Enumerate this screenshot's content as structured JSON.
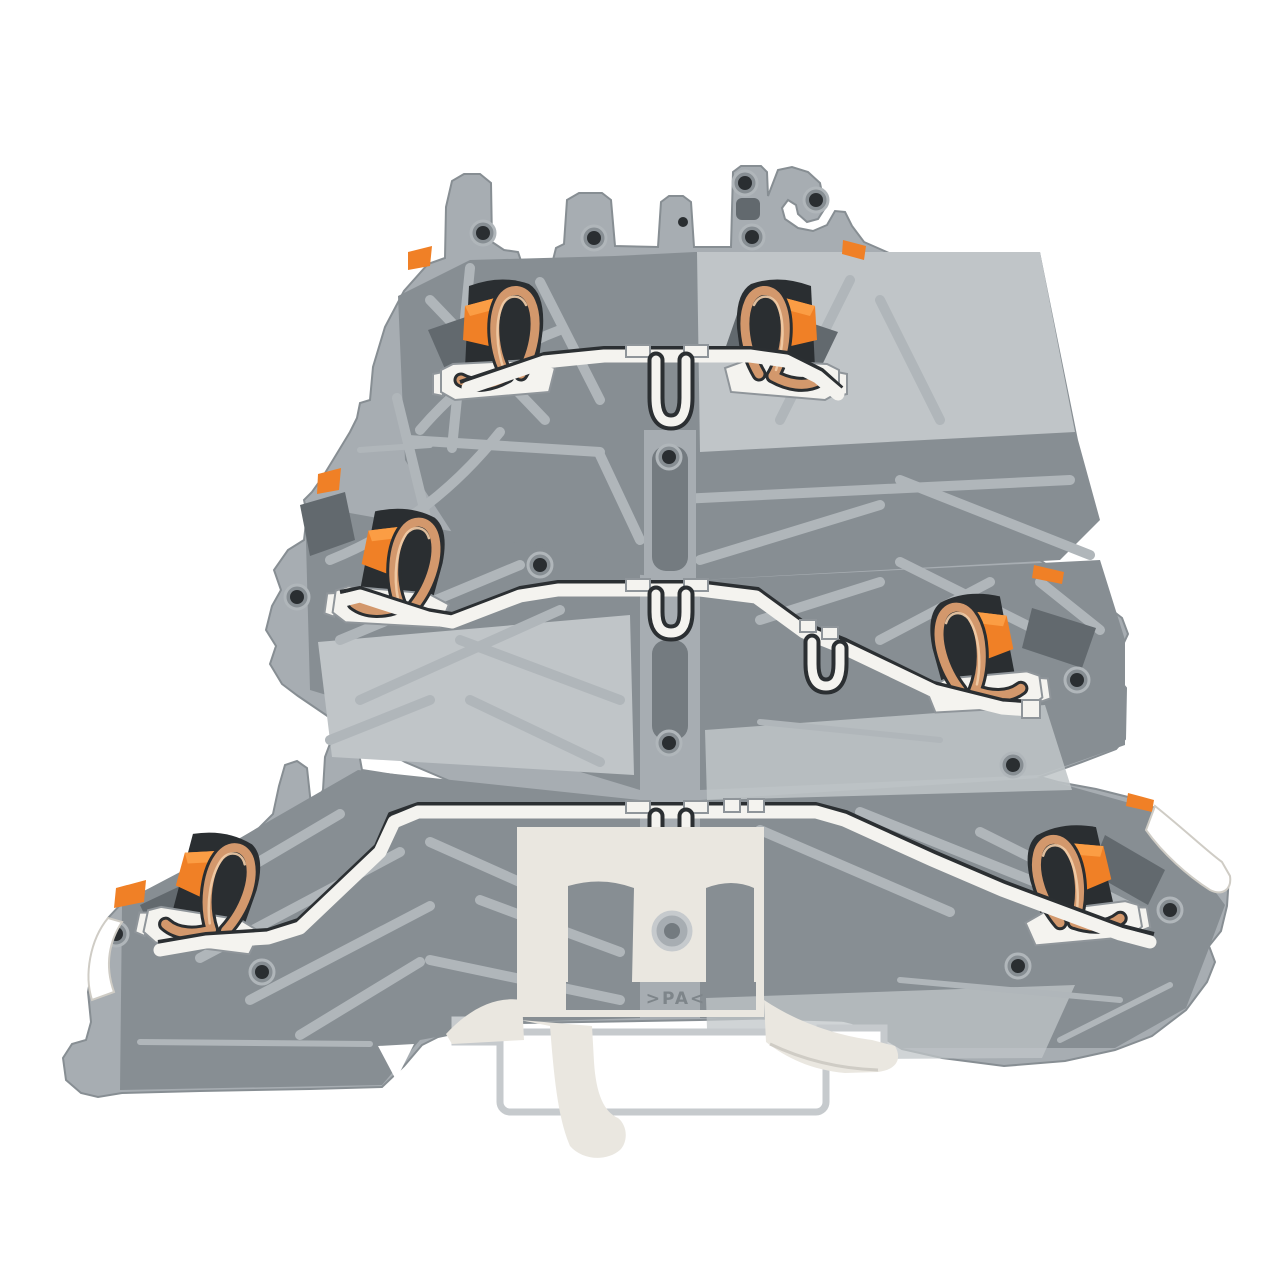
{
  "meta": {
    "description": "Cutaway rendered product photo of a gray three-level feed-through DIN-rail terminal block with push-in spring clamps, orange actuation buttons, copper contact springs, white busbars and a cream DIN-rail mounting foot, on a plain white background."
  },
  "markings": {
    "material_label": ">PA<"
  },
  "levels": [
    {
      "name": "upper level",
      "clamps": [
        "left clamp",
        "right clamp"
      ]
    },
    {
      "name": "middle level",
      "clamps": [
        "left clamp",
        "right clamp"
      ]
    },
    {
      "name": "lower level",
      "clamps": [
        "left clamp",
        "right clamp"
      ]
    }
  ],
  "colors": {
    "background": "#ffffff",
    "body": "#a7adb2",
    "bodyLight": "#c0c5c8",
    "panel": "#878e93",
    "recess": "#747b80",
    "deep": "#62696e",
    "slot": "#2a2e31",
    "rib": "#b0b6ba",
    "orange": "#f08026",
    "orangeLight": "#fb9d44",
    "orangeDark": "#c4600f",
    "copper": "#d3986c",
    "copperLight": "#f2cda9",
    "busbar": "#f4f3ef",
    "busbarEdge": "#8f959a",
    "seam": "#2b2f32",
    "cream": "#eae7e0",
    "creamShadow": "#cfccc5",
    "rail": "#ffffff",
    "railEdge": "#c6cacd",
    "marking": "#7e858a"
  }
}
